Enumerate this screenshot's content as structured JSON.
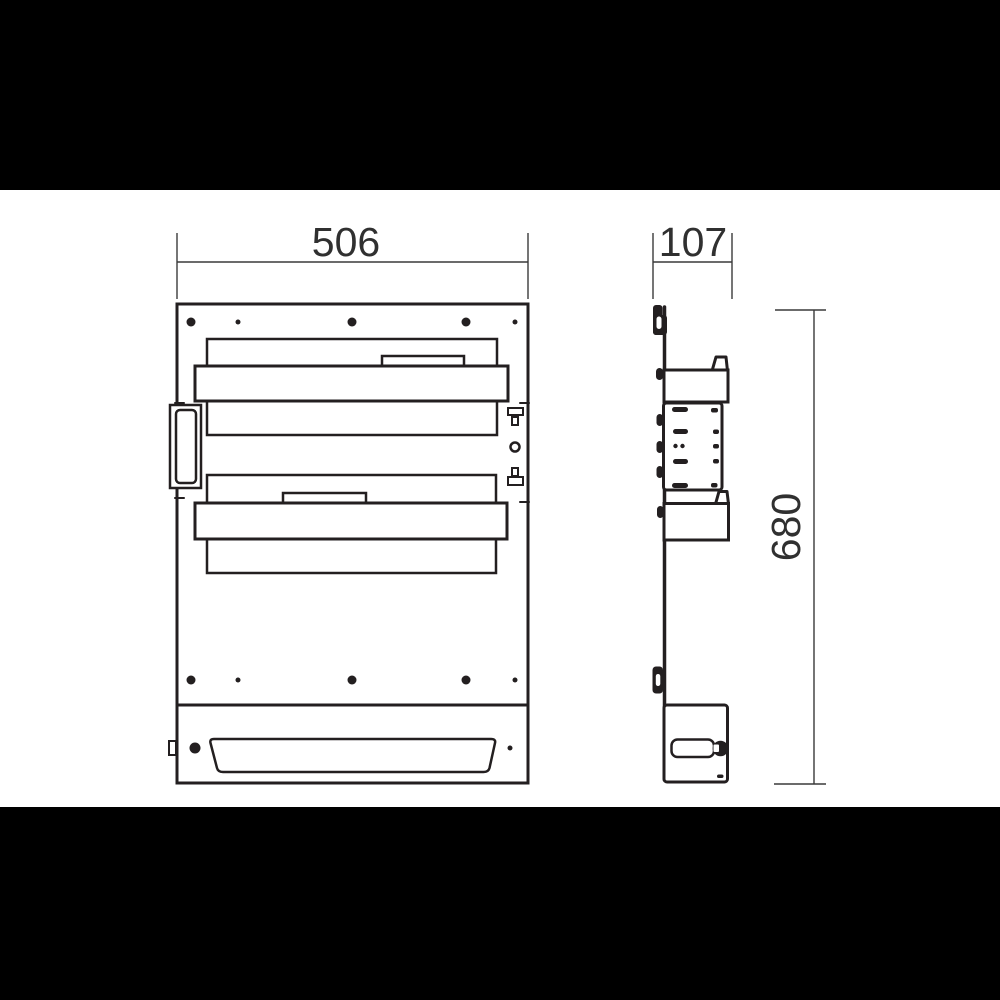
{
  "meta": {
    "drawing_type": "technical dimension drawing, front and side view",
    "background_color": "#ffffff",
    "letterbox_color": "#000000",
    "line_color": "#231f20",
    "dimension_text_color": "#303030"
  },
  "dimensions": {
    "front_width": "506",
    "side_depth": "107",
    "height": "680"
  }
}
